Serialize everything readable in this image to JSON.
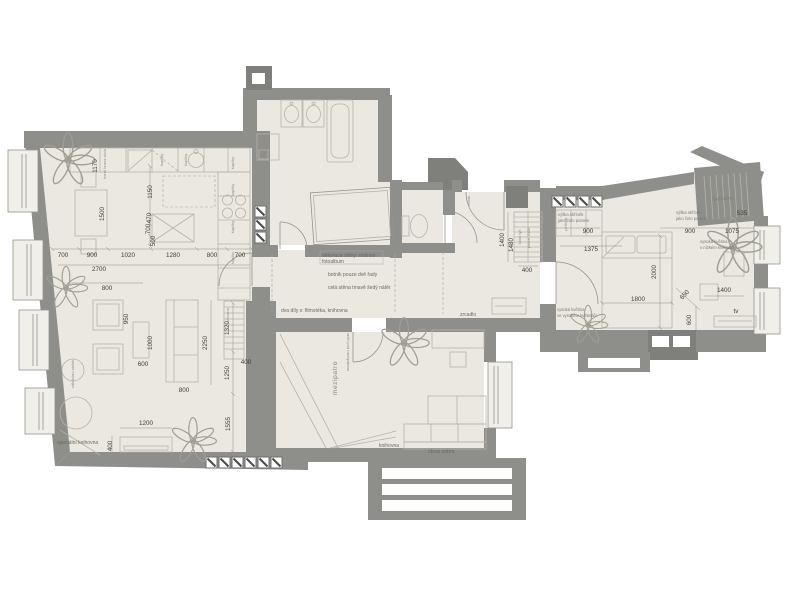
{
  "colors": {
    "wall": "#8e8e8b",
    "wall_dark": "#7f7f7c",
    "floor": "#eae8e1",
    "floor_light": "#f0efe9",
    "furniture_line": "#b6b3a8",
    "dim_text": "#3e3d39",
    "note_text": "#6b6960",
    "plant_line": "#a09e93"
  },
  "plan": {
    "labels": [
      {
        "t": "1170",
        "x": 97,
        "y": 166,
        "r": -90
      },
      {
        "t": "1500",
        "x": 104,
        "y": 214,
        "r": -90
      },
      {
        "t": "1150",
        "x": 152,
        "y": 192,
        "r": -90
      },
      {
        "t": "470",
        "x": 151,
        "y": 218,
        "r": -90
      },
      {
        "t": "700",
        "x": 150,
        "y": 229,
        "r": -90
      },
      {
        "t": "500",
        "x": 155,
        "y": 241,
        "r": -90
      },
      {
        "t": "700",
        "x": 63,
        "y": 257
      },
      {
        "t": "900",
        "x": 92,
        "y": 257
      },
      {
        "t": "1020",
        "x": 128,
        "y": 257
      },
      {
        "t": "1280",
        "x": 173,
        "y": 257
      },
      {
        "t": "800",
        "x": 212,
        "y": 257
      },
      {
        "t": "700",
        "x": 240,
        "y": 257
      },
      {
        "t": "2700",
        "x": 99,
        "y": 271
      },
      {
        "t": "800",
        "x": 107,
        "y": 290
      },
      {
        "t": "950",
        "x": 128,
        "y": 319,
        "r": -90
      },
      {
        "t": "1000",
        "x": 152,
        "y": 343,
        "r": -90
      },
      {
        "t": "600",
        "x": 143,
        "y": 366
      },
      {
        "t": "2250",
        "x": 207,
        "y": 343,
        "r": -90
      },
      {
        "t": "800",
        "x": 184,
        "y": 392
      },
      {
        "t": "1320",
        "x": 229,
        "y": 328,
        "r": -90
      },
      {
        "t": "1250",
        "x": 229,
        "y": 373,
        "r": -90
      },
      {
        "t": "400",
        "x": 246,
        "y": 364
      },
      {
        "t": "1555",
        "x": 230,
        "y": 424,
        "r": -90
      },
      {
        "t": "1200",
        "x": 146,
        "y": 425
      },
      {
        "t": "400",
        "x": 112,
        "y": 446,
        "r": -90
      },
      {
        "t": "1400",
        "x": 504,
        "y": 240,
        "r": -90
      },
      {
        "t": "1480",
        "x": 513,
        "y": 245,
        "r": -90
      },
      {
        "t": "400",
        "x": 527,
        "y": 272
      },
      {
        "t": "900",
        "x": 588,
        "y": 233
      },
      {
        "t": "1375",
        "x": 591,
        "y": 251
      },
      {
        "t": "2000",
        "x": 656,
        "y": 272,
        "r": -90
      },
      {
        "t": "1800",
        "x": 638,
        "y": 301
      },
      {
        "t": "900",
        "x": 690,
        "y": 233
      },
      {
        "t": "1075",
        "x": 732,
        "y": 233
      },
      {
        "t": "535",
        "x": 742,
        "y": 215
      },
      {
        "t": "650",
        "x": 686,
        "y": 296,
        "r": -47
      },
      {
        "t": "600",
        "x": 691,
        "y": 320,
        "r": -90
      },
      {
        "t": "1400",
        "x": 724,
        "y": 292
      },
      {
        "t": "tv",
        "x": 736,
        "y": 313
      },
      {
        "t": "dekorace stěny: rodinné",
        "x": 322,
        "y": 257,
        "k": "n"
      },
      {
        "t": "fotoalbum",
        "x": 322,
        "y": 263,
        "k": "n"
      },
      {
        "t": "botník pouze dvě řady",
        "x": 328,
        "y": 276,
        "k": "n"
      },
      {
        "t": "celá stěna tmavě šedý nátěr",
        "x": 328,
        "y": 289,
        "k": "n"
      },
      {
        "t": "dva díly s: filmotéka, knihovna",
        "x": 281,
        "y": 312,
        "k": "n"
      },
      {
        "t": "zrcadlo",
        "x": 460,
        "y": 316,
        "k": "n"
      },
      {
        "t": "speciální knihovna",
        "x": 57,
        "y": 444,
        "k": "n"
      },
      {
        "t": "knihovna",
        "x": 379,
        "y": 447,
        "k": "n"
      },
      {
        "t": "obraz zebra",
        "x": 428,
        "y": 453,
        "k": "n"
      },
      {
        "t": "výška skříněk",
        "x": 558,
        "y": 216,
        "k": "t"
      },
      {
        "t": "jako čelo postele",
        "x": 558,
        "y": 222,
        "k": "t"
      },
      {
        "t": "výška skříněk",
        "x": 676,
        "y": 214,
        "k": "t"
      },
      {
        "t": "jako čelo postele",
        "x": 676,
        "y": 220,
        "k": "t"
      },
      {
        "t": "vysoká květina",
        "x": 700,
        "y": 243,
        "k": "t"
      },
      {
        "t": "v nízkém květináči",
        "x": 700,
        "y": 249,
        "k": "t"
      },
      {
        "t": "vysoká květina",
        "x": 557,
        "y": 311,
        "k": "t"
      },
      {
        "t": "ve vysokém květináči",
        "x": 557,
        "y": 317,
        "k": "t"
      },
      {
        "t": "ŠATNIČKA",
        "x": 713,
        "y": 201,
        "r": -5,
        "k": "t"
      },
      {
        "t": "šuplíky",
        "x": 234,
        "y": 163,
        "r": -90,
        "k": "r"
      },
      {
        "t": "šuplíky",
        "x": 234,
        "y": 190,
        "r": -90,
        "k": "r"
      },
      {
        "t": "šuplíky",
        "x": 234,
        "y": 227,
        "r": -90,
        "k": "r"
      },
      {
        "t": "šuplíky",
        "x": 234,
        "y": 258,
        "r": -90,
        "k": "r"
      },
      {
        "t": "šuplíky",
        "x": 163,
        "y": 160,
        "r": -90,
        "k": "r"
      },
      {
        "t": "šuplíky",
        "x": 187,
        "y": 160,
        "r": -90,
        "k": "r"
      },
      {
        "t": "peřiňák",
        "x": 567,
        "y": 224,
        "r": -90,
        "k": "r"
      },
      {
        "t": "šatní tyč",
        "x": 521,
        "y": 237,
        "r": -90,
        "k": "r"
      },
      {
        "t": "police 2000",
        "x": 530,
        "y": 238,
        "r": -90,
        "k": "r"
      },
      {
        "t": "věšák",
        "x": 470,
        "y": 201,
        "r": -90,
        "k": "r"
      },
      {
        "t": "odkládací stolek",
        "x": 74,
        "y": 374,
        "r": -90,
        "k": "r"
      },
      {
        "t": "horní hrana stolu",
        "x": 106,
        "y": 164,
        "r": -90,
        "k": "r"
      },
      {
        "t": "skříň pod mezipatrem",
        "x": 347,
        "y": 352,
        "r": 90,
        "k": "r"
      },
      {
        "t": "knihovna",
        "x": 229,
        "y": 316,
        "r": -90,
        "k": "r"
      },
      {
        "t": "mezipatro",
        "x": 337,
        "y": 378,
        "r": -90,
        "k": "m"
      }
    ]
  }
}
